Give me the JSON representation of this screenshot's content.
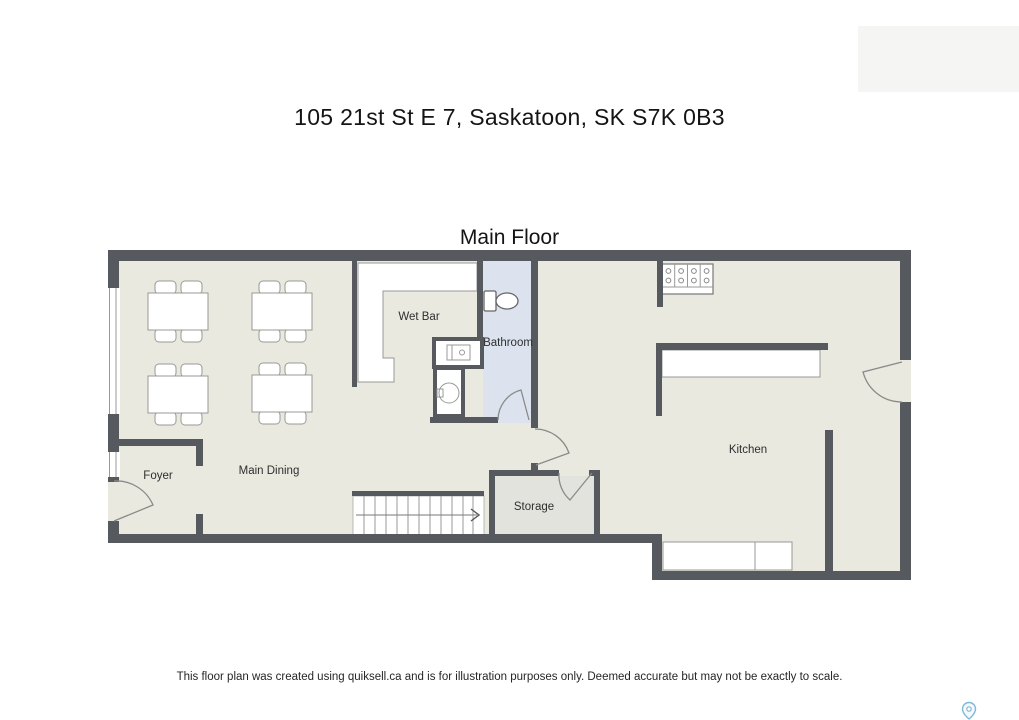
{
  "page": {
    "title": "105 21st St E 7, Saskatoon, SK S7K 0B3",
    "floor_label": "Main Floor",
    "disclaimer": "This floor plan was created using quiksell.ca and is for illustration purposes only. Deemed accurate but may not be exactly to scale."
  },
  "plan": {
    "rooms": {
      "wet_bar": "Wet Bar",
      "bathroom": "Bathroom",
      "main_dining": "Main Dining",
      "foyer": "Foyer",
      "storage": "Storage",
      "kitchen": "Kitchen"
    },
    "furniture": {
      "dining_tables": 4,
      "chairs_per_table": 4
    }
  },
  "icons": {
    "stairs_direction_arrow": "chevron-right",
    "map_pin": "location-pin"
  },
  "colors": {
    "wall": "#565a5e",
    "floor": "#e9e9e0",
    "bathroom_floor": "#dde3ee",
    "storage_floor": "#e3e3de",
    "fixture_outline": "#999999",
    "pin_accent": "#7db8d6"
  }
}
